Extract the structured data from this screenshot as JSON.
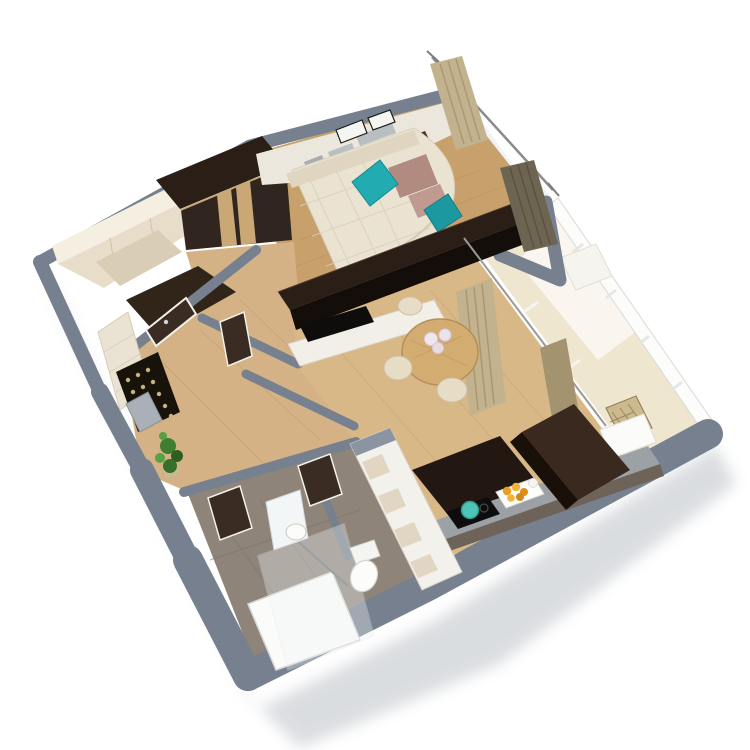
{
  "image": {
    "kind": "isometric-3d-apartment-floorplan-render",
    "background": "#ffffff"
  },
  "scene": {
    "rooms": [
      "living-room",
      "kitchen-dining",
      "hallway",
      "walk-in-closet",
      "bathroom",
      "wc",
      "balcony"
    ],
    "furniture": [
      "corner-sofa",
      "teal-pillows",
      "wardrobe",
      "tv-partition",
      "sideboard",
      "dining-table",
      "chairs",
      "tall-kitchen-unit",
      "kitchen-counter",
      "cooktop",
      "fruit-tray",
      "wall-niches",
      "shower",
      "sink-mirror",
      "toilet",
      "plant",
      "entrance-door",
      "curtains",
      "balcony-railing",
      "rattan-chair"
    ]
  },
  "palette": {
    "wallTop": "#76808e",
    "wallLight": "#8b95a2",
    "glass": "#f0f3f6",
    "woodLiving": "#c7a06c",
    "woodHall": "#d4b285",
    "woodKitchen": "#d9b888",
    "woodBalcony": "#efe6d0",
    "tileBath": "#8e847a",
    "floorCloset": "#31251a",
    "creamWallBright": "#f5efe2",
    "creamCabinet": "#e8ddc8",
    "creamCabinetDark": "#d9cdb5",
    "stoneWall": "#eae3d4",
    "espressoTop": "#2b1e17",
    "espressoFront": "#140e0b",
    "oakDoor": "#c9a876",
    "sofaCream": "#eae3d1",
    "sofaBack": "#dfd5c0",
    "teal": "#22abb1",
    "tealDark": "#1b98a0",
    "mauve": "#b18a80",
    "mauveLight": "#c09a90",
    "darkConsole": "#4a3026",
    "tvBlack": "#0e0d0c",
    "sideboard": "#f1efe8",
    "tableOak": "#d3ac72",
    "chairCream": "#e7ddc7",
    "fridgeTop": "#39291f",
    "fridgeFront": "#191009",
    "darkCabinet": "#221711",
    "counterTop": "#9ba1a5",
    "counterFront": "#6e6358",
    "cooktop": "#0d0d0d",
    "potTeal": "#4cc4b8",
    "trayWhite": "#fdfdfc",
    "orange": "#ea9e1e",
    "orangeLight": "#f3b23a",
    "nicheWall": "#f3f1ec",
    "nicheInner": "#e0d6c2",
    "white": "#fbfbfa",
    "doorBrown": "#3a2c22",
    "doorFrame": "#f2f1ea",
    "curtain": "#c2b28e",
    "curtainShade": "#a3946f",
    "curtainDark": "#6e6452",
    "matBlack": "#17130b",
    "matDot": "#c9b27c",
    "leaf": "#3f7d31",
    "leafDark": "#2c6021",
    "leafLight": "#57a043",
    "plantPot": "#cbb791",
    "mirror": "#f3f6f6",
    "porcelain": "#fcfcfa",
    "chrome": "#9aa0a8",
    "railing": "#fcfcfb",
    "benchWhite": "#f6f4ee",
    "rattan": "#cdb98e",
    "shadow": "#8f97a1",
    "wallFace": "#ece7dd",
    "grayPanel": "#b9bec0",
    "whitePanel": "#f5f5f3",
    "ventGray": "#a7adb0"
  }
}
